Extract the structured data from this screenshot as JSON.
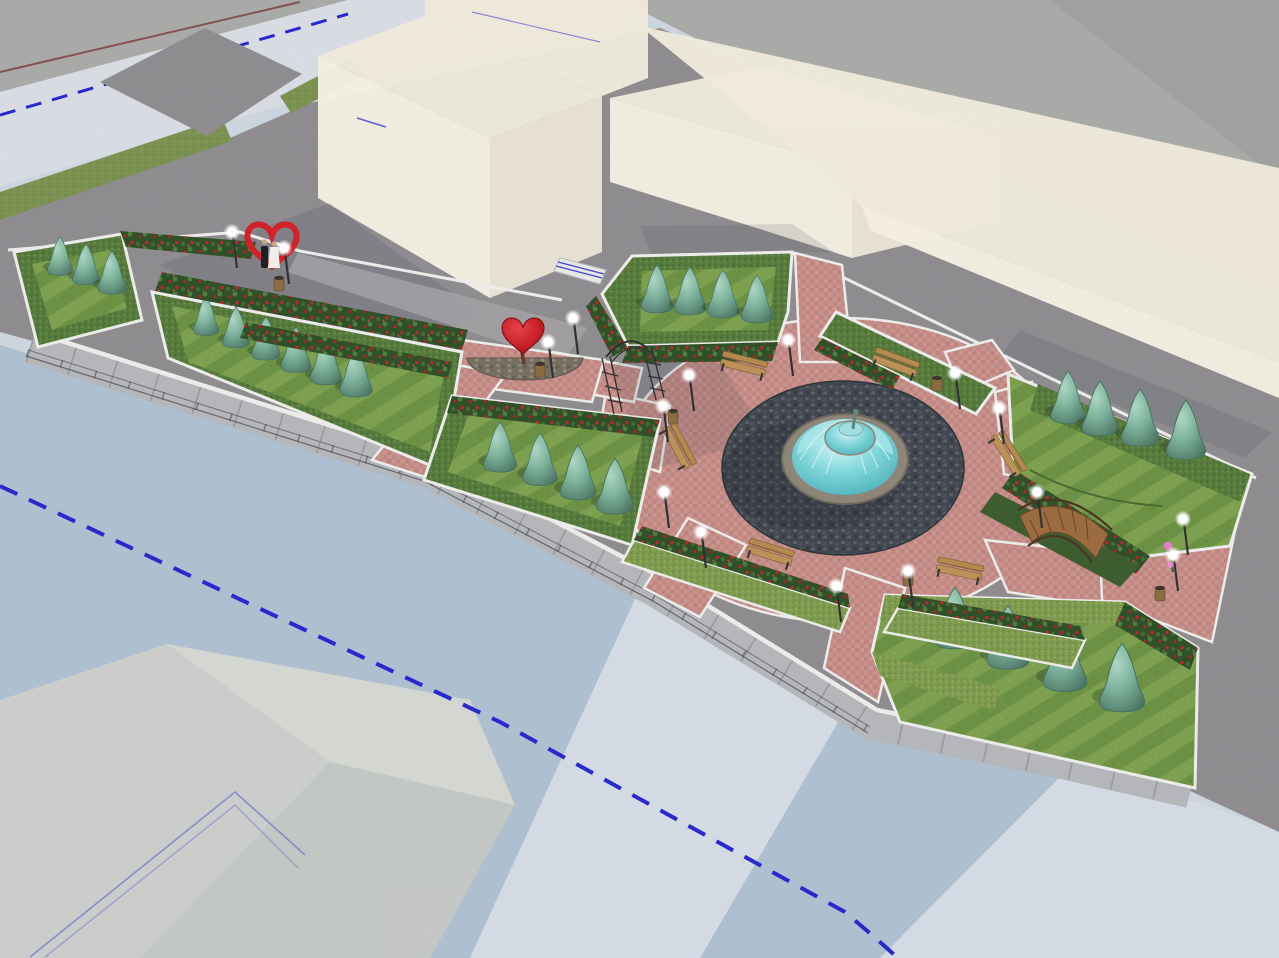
{
  "scene": {
    "type": "3d-landscape-render",
    "description": "aerial perspective render of a formal pocket park with central fountain plaza",
    "objects": {
      "garden_beds": 6,
      "topiary_cones": 25,
      "plaza_benches": 6,
      "street_lamps": 16,
      "trash_bins": 6,
      "fountains": 1,
      "heart_arch_sculptures": 1,
      "heart_topiaries": 1,
      "garden_arch_trellises": 1,
      "wooden_bridges": 1,
      "couple_figures": 2,
      "building_masses": 4
    }
  },
  "colors": {
    "backdrop": "#a9a9a7",
    "backdrop_dark": "#9c9c9a",
    "road": "#8e8c8f",
    "sidewalk_light": "#d8dce3",
    "sidewalk_band": "#b4b6ba",
    "plaza_pale": "#ccd5df",
    "plaza_blue": "#aebfd0",
    "plaza_light_band": "#d4dbe4",
    "pyramid_light": "#dedcd3",
    "pyramid_mid": "#d2d1c9",
    "pyramid_dark": "#c9c9c1",
    "curb_white": "#ecedea",
    "lawn": "#6f9245",
    "hedge": "#567a3c",
    "hedge_light": "#7e9b4e",
    "flower_bed": "#2e4f27",
    "flower_red": "#c0232b",
    "topiary_teal": "#7db29b",
    "water_cyan": "#7fd6da",
    "fountain_stone": "#8d8577",
    "bench_wood": "#b3894f",
    "metal_dark": "#2f3033",
    "heart_red": "#d41f27",
    "building_front": "#f5f0e2",
    "building_side": "#e9e4d5",
    "building_top": "#efeadb",
    "grass_green": "#7a9150",
    "boundary_blue": "#2727cf",
    "marker_red": "#7b3a37",
    "outline_violet": "#6a5fd0",
    "bridge_wood": "#9c6b3f",
    "channel_green": "#3c5c2e",
    "bin_brown": "#8a6b42",
    "glow_white": "#ffffff",
    "shadow": "#39404e",
    "concrete_court": "#a3a1a4"
  }
}
